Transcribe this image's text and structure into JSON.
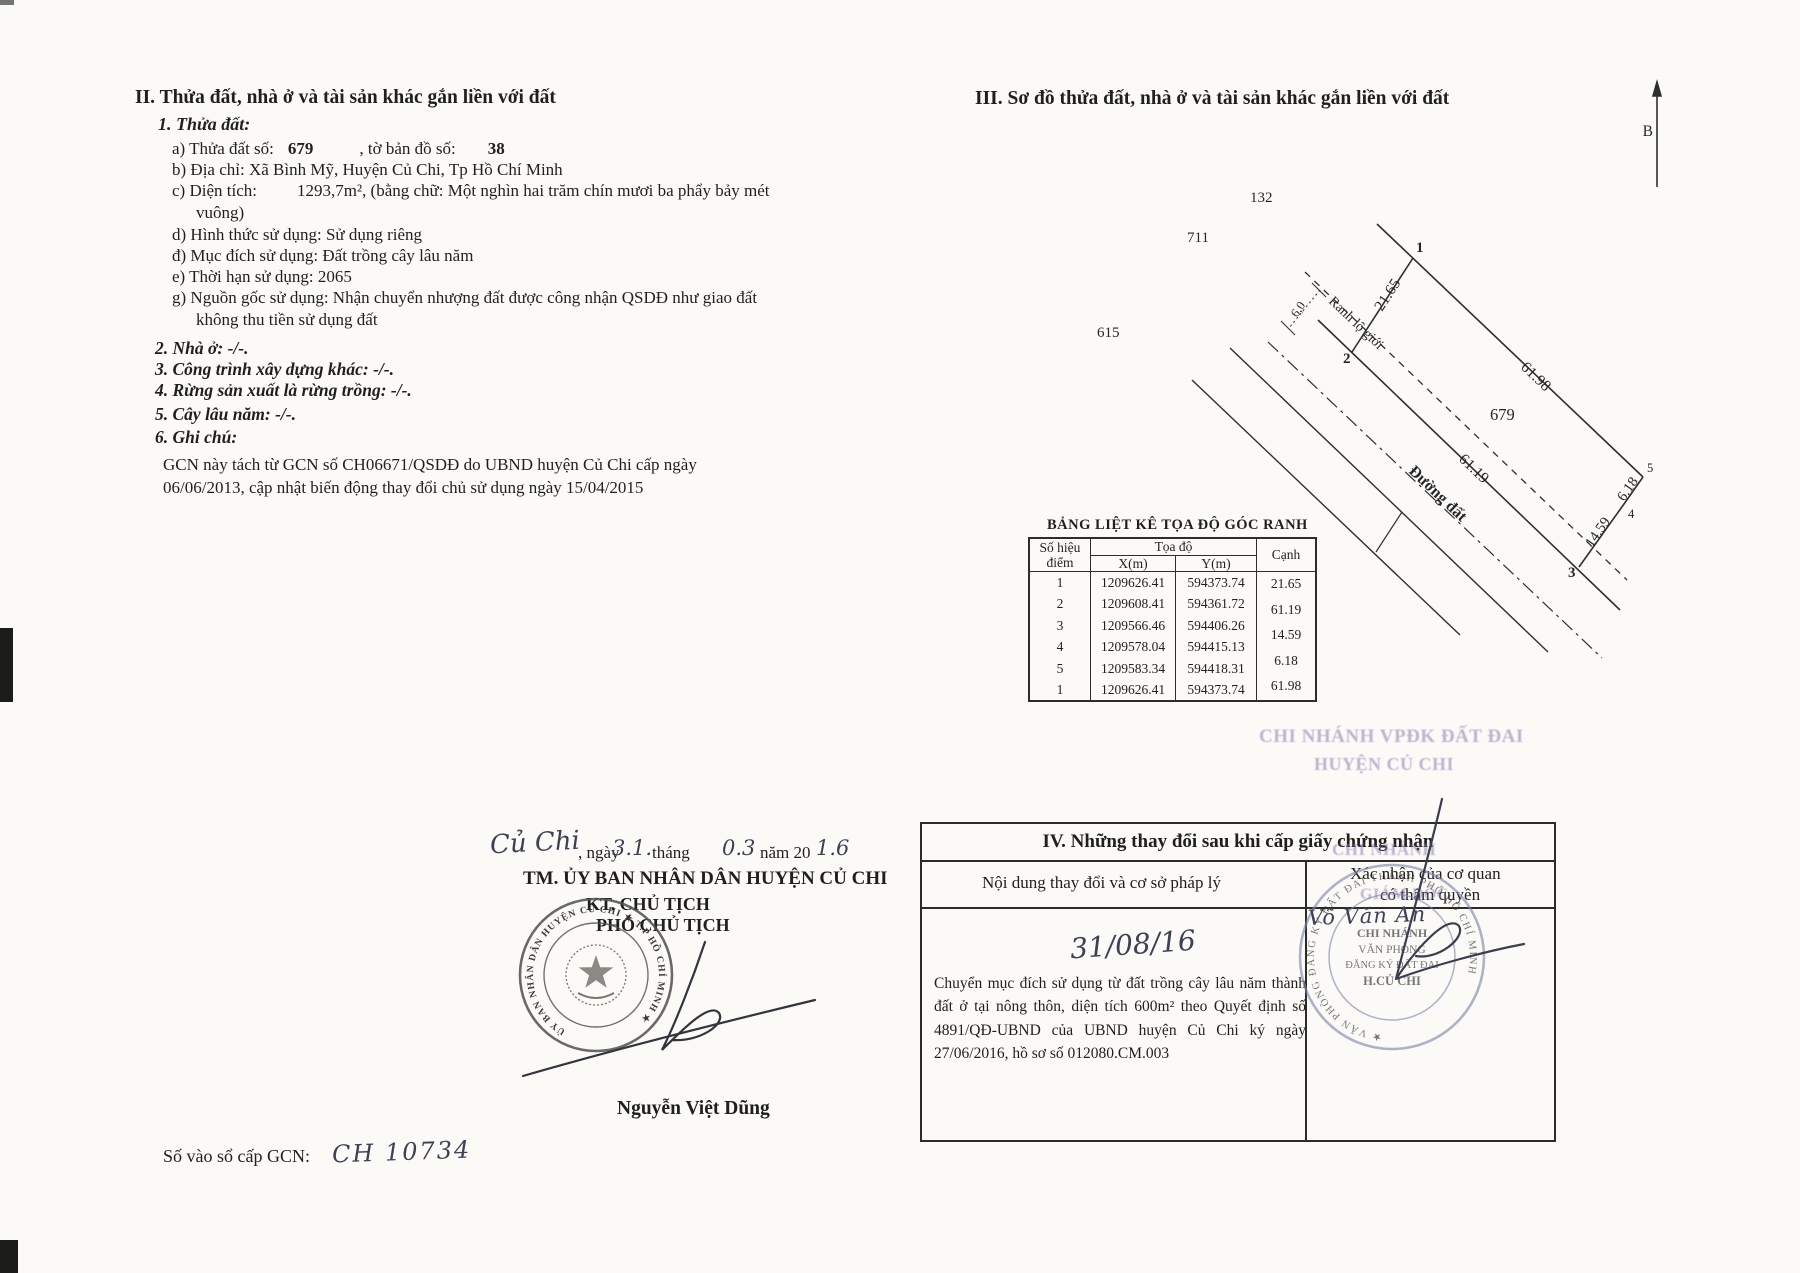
{
  "left": {
    "section_title": "II. Thửa đất, nhà ở và tài sản khác gắn liền với đất",
    "parcel_heading": "1. Thửa đất:",
    "a_label": "a) Thửa đất số:",
    "a_value": "679",
    "a_label2": ", tờ bản đồ số:",
    "a_value2": "38",
    "b_line": "b) Địa chỉ:  Xã Bình Mỹ, Huyện Củ Chi, Tp Hồ Chí Minh",
    "c_label": "c) Diện tích:",
    "c_value": "1293,7m², (bằng chữ: Một nghìn hai trăm chín mươi ba phẩy bảy mét",
    "c_wrap": "vuông)",
    "d_line": "d) Hình thức sử dụng:   Sử dụng riêng",
    "dd_line": "đ) Mục đích sử dụng:  Đất trồng cây lâu năm",
    "e_line": "e) Thời hạn sử dụng:  2065",
    "g_line": "g) Nguồn gốc sử dụng:  Nhận chuyển nhượng đất được công nhận QSDĐ như giao đất",
    "g_wrap": "không thu tiền sử dụng đất",
    "item2": "2. Nhà ở:  -/-.",
    "item3": "3. Công trình xây dựng khác: -/-.",
    "item4": "4. Rừng sản xuất là rừng trồng: -/-.",
    "item5": "5. Cây lâu năm:  -/-.",
    "item6": "6. Ghi chú:",
    "note_line1": "GCN này tách từ GCN số CH06671/QSDĐ do UBND huyện Củ Chi cấp ngày",
    "note_line2": "06/06/2013, cập nhật biến động thay đổi chủ sử dụng ngày 15/04/2015",
    "sign": {
      "place_hw": "Củ Chi",
      "ngay_label": ", ngày",
      "day_hw": "3.1.",
      "thang_label": "tháng",
      "month_hw": "0.3",
      "nam_label": "năm 20",
      "year_hw": "1.6",
      "authority": "TM. ỦY BAN NHÂN DÂN HUYỆN CỦ CHI",
      "kt_line": "KT. CHỦ TỊCH",
      "deputy_line": "PHÓ CHỦ TỊCH",
      "signer_name": "Nguyễn Việt Dũng",
      "seal_ring": "ỦY BAN NHÂN DÂN HUYỆN CỦ CHI ★ T.P HỒ CHÍ MINH ★"
    },
    "gcn_label": "Số vào sổ cấp GCN:",
    "gcn_value_hw": "CH 10734"
  },
  "right": {
    "section_title": "III. Sơ đồ thửa đất, nhà ở và tài sản khác gắn liền với đất",
    "diagram": {
      "north_label": "B",
      "parcel_number": "679",
      "neighbor_top": "132",
      "neighbor_left": "711",
      "neighbor_bottom": "615",
      "road_label": "Đường đất",
      "boundary_label": "Ranh lộ giới",
      "setback_width": "6,0",
      "edge_12": "21.65",
      "edge_23": "61.19",
      "edge_34": "14.59",
      "edge_45": "6.18",
      "edge_51": "61.98",
      "pt1": "1",
      "pt2": "2",
      "pt3": "3",
      "pt4": "4",
      "pt5": "5"
    },
    "coord_table": {
      "title": "BẢNG LIỆT KÊ TỌA ĐỘ GÓC RANH",
      "col_point_1": "Số hiệu",
      "col_point_2": "điểm",
      "col_coord": "Tọa độ",
      "col_x": "X(m)",
      "col_y": "Y(m)",
      "col_edge": "Cạnh",
      "rows": [
        {
          "p": "1",
          "x": "1209626.41",
          "y": "594373.74"
        },
        {
          "p": "2",
          "x": "1209608.41",
          "y": "594361.72"
        },
        {
          "p": "3",
          "x": "1209566.46",
          "y": "594406.26"
        },
        {
          "p": "4",
          "x": "1209578.04",
          "y": "594415.13"
        },
        {
          "p": "5",
          "x": "1209583.34",
          "y": "594418.31"
        },
        {
          "p": "1",
          "x": "1209626.41",
          "y": "594373.74"
        }
      ],
      "edge_values": [
        "21.65",
        "61.19",
        "14.59",
        "6.18",
        "61.98"
      ]
    },
    "section4": {
      "title": "IV. Những thay đổi sau khi cấp giấy chứng nhận",
      "col_content": "Nội dung thay đổi và cơ sở pháp lý",
      "col_confirm_1": "Xác nhận của cơ quan",
      "col_confirm_2": "có thẩm quyền",
      "date_hw": "31/08/16",
      "content": "Chuyển mục đích sử dụng từ đất trồng cây lâu năm thành đất ở tại nông thôn, diện tích 600m² theo Quyết định số 4891/QĐ-UBND của UBND huyện Củ Chi ký ngày 27/06/2016, hồ sơ số 012080.CM.003",
      "overlay_line1": "CHI NHÁNH VPĐK ĐẤT ĐAI",
      "overlay_line2": "HUYỆN CỦ CHI",
      "overlay_line3": "CHI NHÁNH",
      "overlay_line4": "GIÁM ĐỐC",
      "signer_hw": "Võ Văn An",
      "stamp": {
        "ring": "★ VĂN PHÒNG ĐĂNG KÝ ĐẤT ĐAI THÀNH PHỐ HỒ CHÍ MINH ",
        "l1": "CHI NHÁNH",
        "l2": "VĂN PHÒNG",
        "l3": "ĐĂNG KÝ ĐẤT ĐAI",
        "l4": "H.CỦ CHI"
      }
    }
  }
}
